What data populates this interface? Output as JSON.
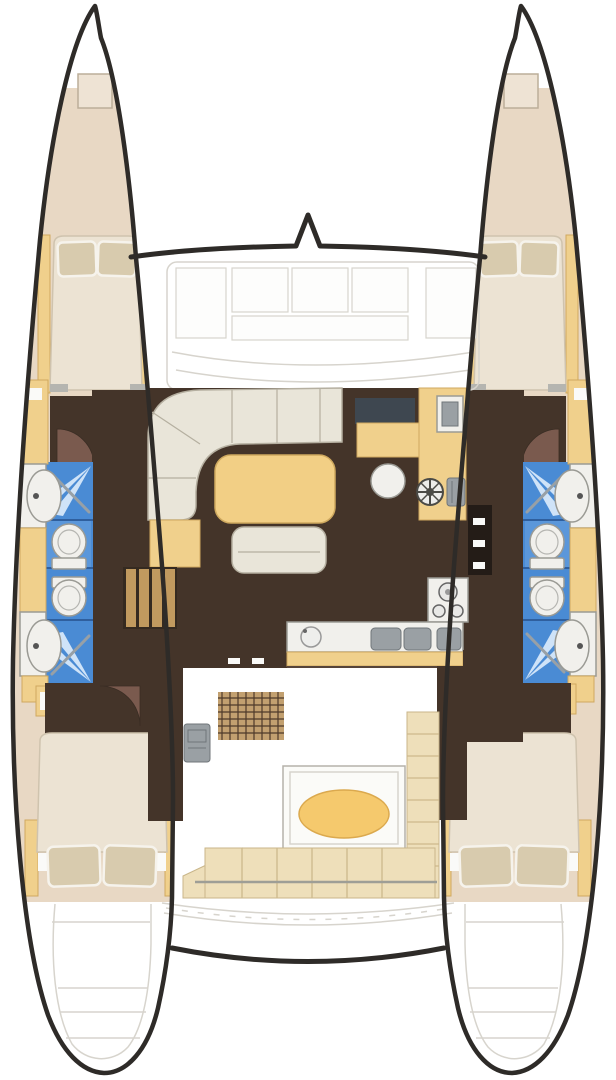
{
  "diagram": {
    "label": "Catamaran yacht interior deck plan, top view",
    "type": "boat-floor-plan",
    "view": "overhead"
  },
  "regions": {
    "port_hull": [
      "bow-anchor-locker",
      "forward-double-berth",
      "forward-head-washbasin",
      "forward-head-shower",
      "forward-toilet",
      "aft-toilet",
      "aft-head-shower",
      "aft-head-washbasin",
      "hull-companionway-steps",
      "aft-double-berth",
      "transom-steps"
    ],
    "starboard_hull": [
      "bow-anchor-locker",
      "forward-double-berth",
      "forward-head-washbasin",
      "forward-head-shower",
      "forward-toilet",
      "aft-toilet",
      "aft-head-shower",
      "aft-head-washbasin",
      "hull-companionway-steps",
      "aft-double-berth",
      "transom-steps"
    ],
    "bridgedeck": [
      "foredeck-coachroof",
      "salon-settee",
      "salon-table",
      "salon-bench",
      "nav-station",
      "galley-counter",
      "galley-winch",
      "stove",
      "galley-sinks",
      "round-stool",
      "cockpit-grate",
      "helm-box",
      "cockpit-table",
      "cockpit-bench",
      "aft-crossbeam"
    ]
  },
  "colors": {
    "outline": "#2e2b28",
    "faint": "#d7d4cd",
    "deck_beige": "#e8d8c4",
    "hatch_beige": "#eee3d4",
    "floor_dark": "#443429",
    "panel_dark": "#241c17",
    "door_brown": "#7a5a4e",
    "tile_blue": "#4a8bd4",
    "tile_blue_light": "#5b97da",
    "ray_blue": "#cfe3f8",
    "divider_blue": "#2f5f9e",
    "chrome": "#98a0a6",
    "fixture_white": "#f1f0ec",
    "fixture_edge": "#9a9a94",
    "mattress": "#ece3d3",
    "mattress_edge": "#cfc3ae",
    "pillow": "#d8cbae",
    "pillow_edge": "#f6f3ec",
    "furn_yellow": "#f0d08c",
    "furn_yellow_edge": "#cfa95f",
    "settee": "#e9e5d9",
    "settee_edge": "#b5afa0",
    "table_yellow": "#f2cf85",
    "nav_navy": "#3e4750",
    "gray": "#9aa0a4",
    "gray_edge": "#70767a",
    "bench": "#eedfba",
    "bench_edge": "#c9b68a",
    "bench_line": "#cdb98c",
    "grate": "#c2a070",
    "grate_line": "#4e3a2a",
    "step_base": "#352a20",
    "step_bar": "#c19a5f",
    "stripe_gray": "#9e9e96",
    "cockpit_table_yellow": "#f5c96d"
  }
}
